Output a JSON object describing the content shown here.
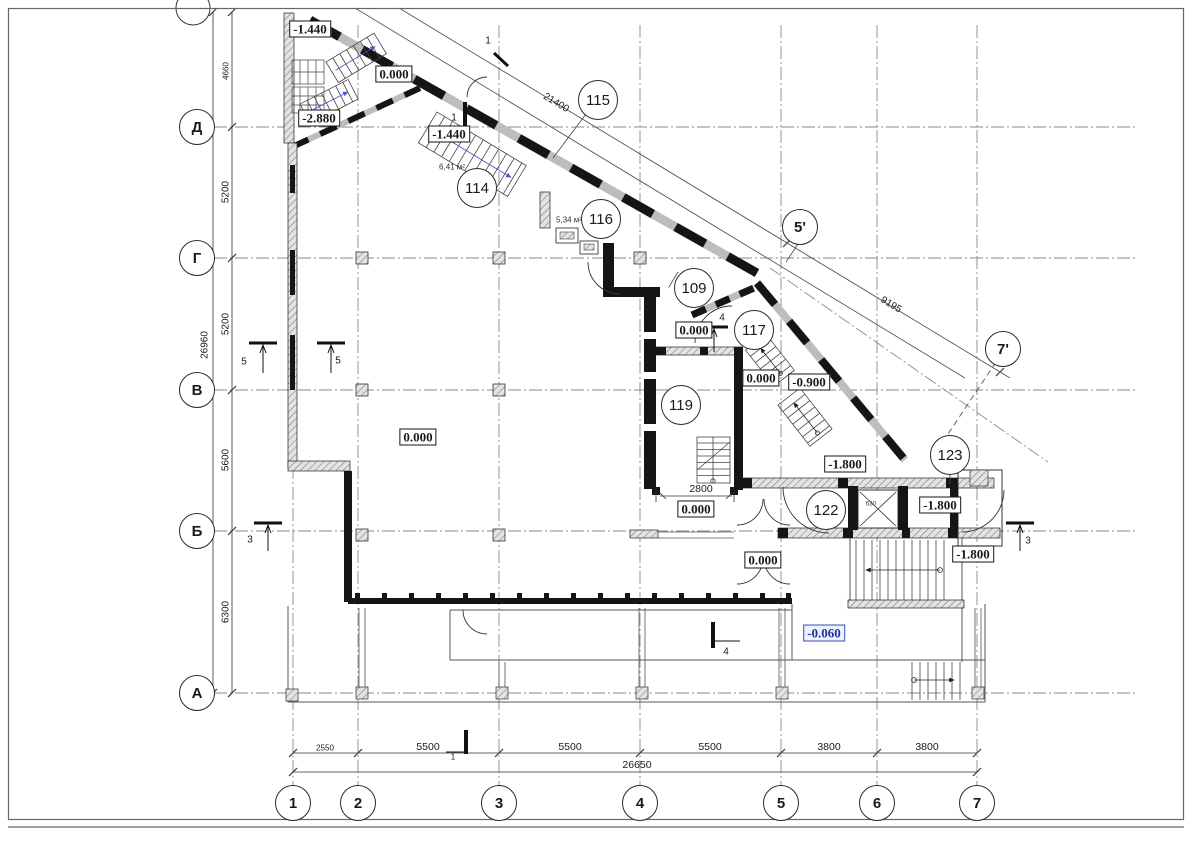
{
  "axes": {
    "rows": [
      "Д",
      "Г",
      "В",
      "Б",
      "А"
    ],
    "cols": [
      "1",
      "2",
      "3",
      "4",
      "5",
      "6",
      "7"
    ],
    "diagonal": [
      "5'",
      "7'"
    ]
  },
  "rooms": [
    "115",
    "114",
    "116",
    "109",
    "117",
    "119",
    "122",
    "123"
  ],
  "levels": {
    "stair_top": "-1.440",
    "stair_mid": "0.000",
    "stair_low": "-2.880",
    "hall114": "-1.440",
    "vest117": "0.000",
    "corr_right": "0.000",
    "ramp": "-0.900",
    "main_hall": "0.000",
    "corr122": "-1.800",
    "lift_lobby": "-1.800",
    "stair_right": "-1.800",
    "vest119": "0.000",
    "vest_lower": "0.000",
    "porch": "-0.060"
  },
  "dimensions": {
    "left": [
      "4660",
      "5200",
      "5200",
      "5600",
      "6300"
    ],
    "left_total": "26960",
    "bottom": [
      "2550",
      "5500",
      "5500",
      "5500",
      "3800",
      "3800"
    ],
    "bottom_total": "26650",
    "diag_upper": "21400",
    "diag_lower": "9195",
    "stair_width": "2800",
    "shaft": "630"
  },
  "areas": {
    "room114": "6,41 м²",
    "room116": "5,34 м²"
  },
  "sections": {
    "s1": "1",
    "s3": "3",
    "s4": "4",
    "s5": "5"
  },
  "colors": {
    "level_accent": "#1b2f9e",
    "line": "#1a1a1a",
    "grid": "#8a8a8a"
  }
}
